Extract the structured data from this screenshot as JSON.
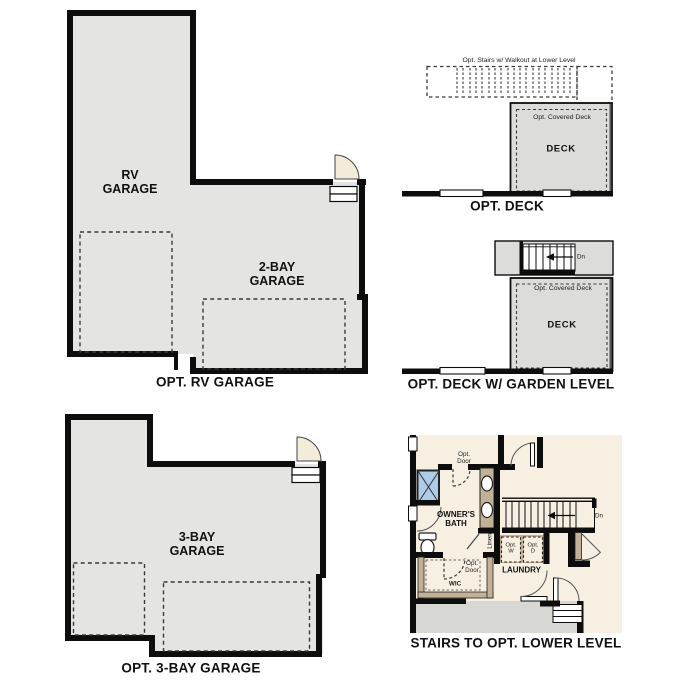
{
  "colors": {
    "wall": "#0d0d0d",
    "garage_fill": "#e4e4e2",
    "deck_fill": "#dcdcda",
    "plan_bg": "#f6efe2",
    "lower_level_fill": "#d7d7d4",
    "counter_tan": "#c3b196",
    "shower_blue": "#aecbe8",
    "door_fill": "#f3ecdb"
  },
  "rv": {
    "label": "RV GARAGE",
    "label2": "2-BAY GARAGE",
    "caption": "OPT. RV GARAGE"
  },
  "deck": {
    "note": "Opt. Stairs w/ Walkout at Lower Level",
    "covered": "Opt. Covered Deck",
    "label": "DECK",
    "caption": "OPT. DECK"
  },
  "garden": {
    "covered": "Opt. Covered Deck",
    "label": "DECK",
    "dn": "Dn",
    "caption": "OPT. DECK W/ GARDEN LEVEL"
  },
  "bay3": {
    "label": "3-BAY GARAGE",
    "caption": "OPT. 3-BAY GARAGE"
  },
  "stairs": {
    "opt_door": "Opt. Door",
    "bath": "OWNER'S BATH",
    "linen": "Linen",
    "dn": "Dn",
    "opt_w": "Opt. W",
    "opt_d": "Opt. D",
    "laundry": "LAUNDRY",
    "opt_door_wic": "Opt. Door",
    "wic": "WIC",
    "caption": "STAIRS TO OPT. LOWER LEVEL"
  }
}
